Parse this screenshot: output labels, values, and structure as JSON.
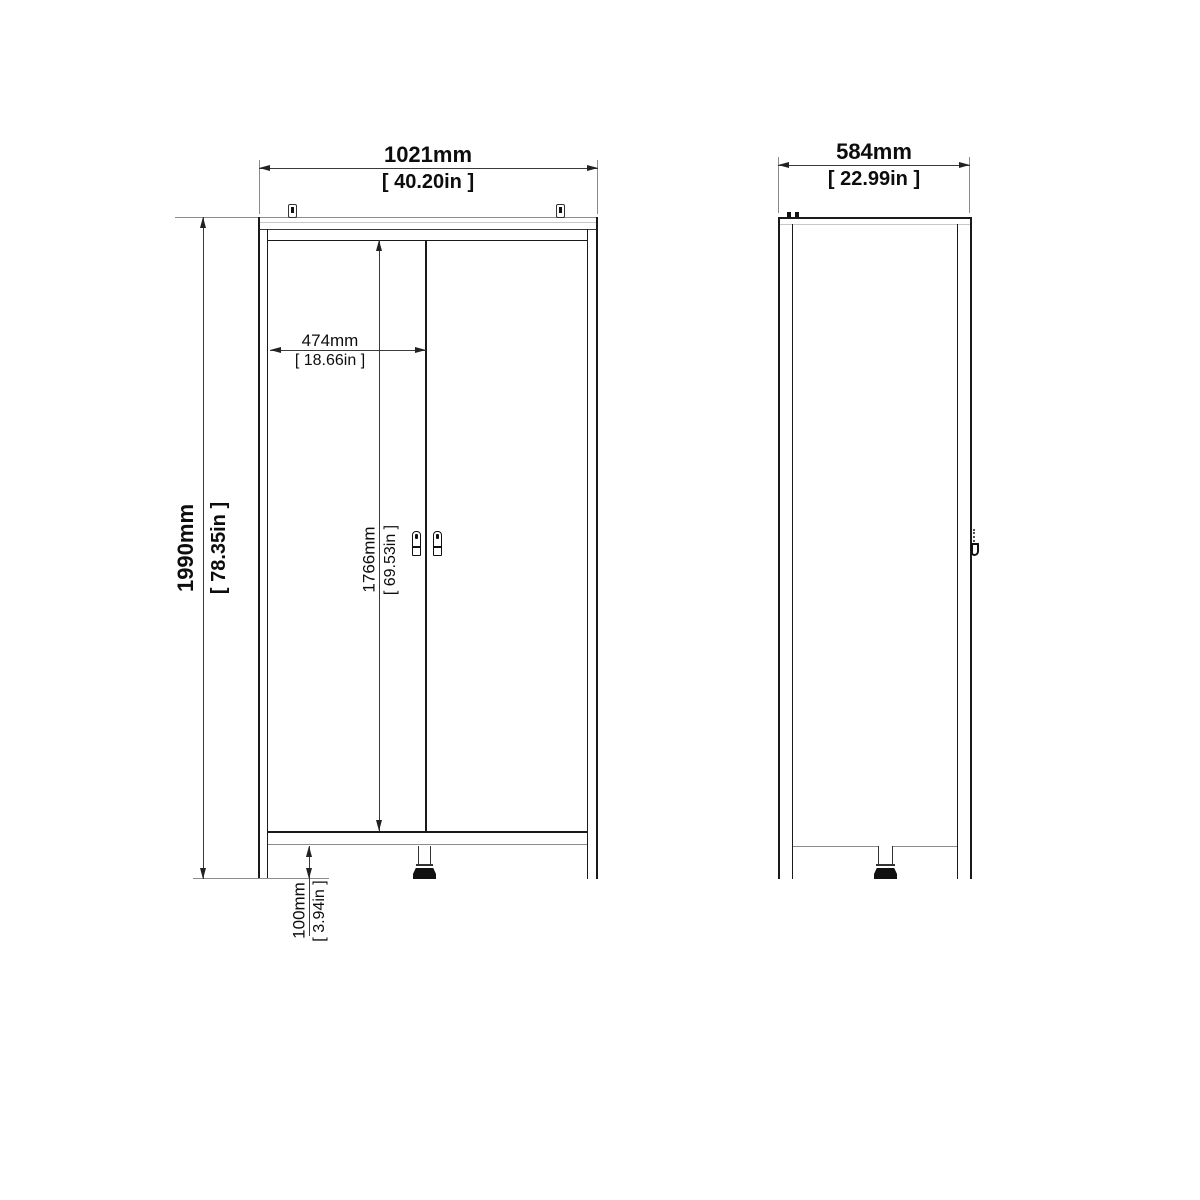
{
  "colors": {
    "background": "#ffffff",
    "cabinet_line": "#1a1a1a",
    "dimension_line": "#3a3a3a",
    "extension_line": "#8c8c8c",
    "text": "#0d0d0d"
  },
  "dims": {
    "overall_width_mm": "1021mm",
    "overall_width_in": "[ 40.20in ]",
    "overall_height_mm": "1990mm",
    "overall_height_in": "[ 78.35in ]",
    "door_width_mm": "474mm",
    "door_width_in": "[ 18.66in ]",
    "door_height_mm": "1766mm",
    "door_height_in": "[ 69.53in ]",
    "leg_height_mm": "100mm",
    "leg_height_in": "[ 3.94in ]",
    "depth_mm": "584mm",
    "depth_in": "[ 22.99in ]"
  },
  "icons": {
    "wall_bracket": "wall-mount-bracket",
    "door_handle": "door-handle",
    "adjustable_foot": "adjustable-foot",
    "side_handle_profile": "door-handle-side-profile"
  }
}
